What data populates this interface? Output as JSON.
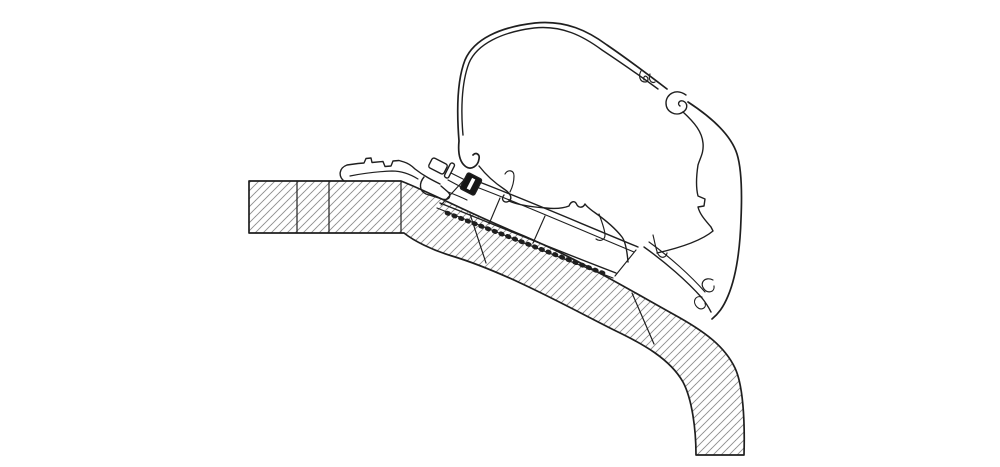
{
  "colors": {
    "outline": "#1f1f1f",
    "hatch": "#8f8f8f",
    "background": "#ffffff",
    "fastener_fill": "#161616",
    "highlight": "#ffffff"
  },
  "diagram": {
    "type": "technical-line-drawing",
    "subject": "awning-roof-adapter-cross-section",
    "parts": [
      "vehicle-roof-panel",
      "roof-panel-joint-lines",
      "adapter-foot-profile",
      "adapter-sloped-rail",
      "hex-bolt",
      "slider-nut",
      "awning-case-profile"
    ]
  }
}
